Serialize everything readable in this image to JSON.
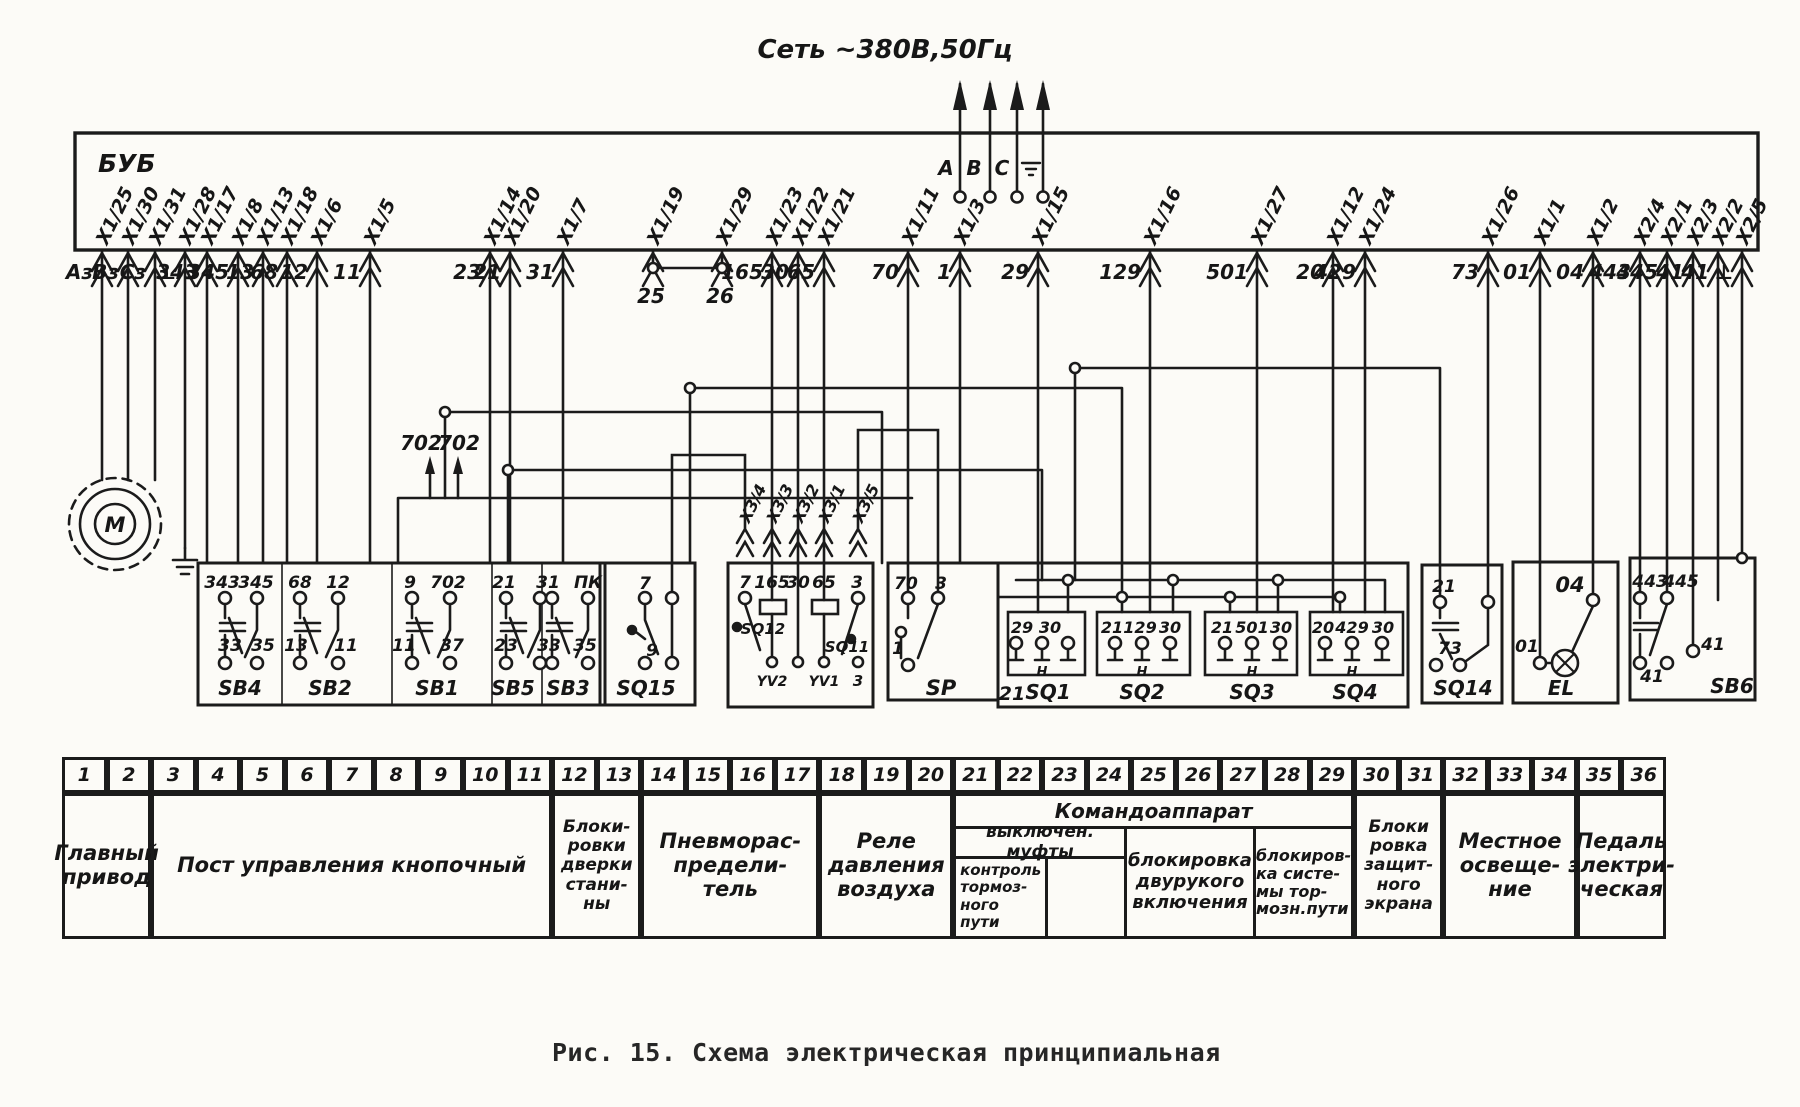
{
  "network": {
    "title": "Сеть ~380В,50Гц",
    "phase_a": "A",
    "phase_b": "B",
    "phase_c": "C"
  },
  "bub": {
    "name": "БУБ",
    "terminals": [
      {
        "t": "X1/25",
        "n": "Аз"
      },
      {
        "t": "X1/30",
        "n": "Вз"
      },
      {
        "t": "X1/31",
        "n": "Сз"
      },
      {
        "t": "X1/28",
        "n": "⊥"
      },
      {
        "t": "X1/17",
        "n": "343"
      },
      {
        "t": "X1/8",
        "n": "345"
      },
      {
        "t": "X1/13",
        "n": "13"
      },
      {
        "t": "X1/18",
        "n": "68"
      },
      {
        "t": "X1/6",
        "n": "12"
      },
      {
        "t": "X1/5",
        "n": "11"
      },
      {
        "t": "X1/14",
        "n": "23"
      },
      {
        "t": "X1/20",
        "n": "21"
      },
      {
        "t": "X1/7",
        "n": "31"
      },
      {
        "t": "X1/19",
        "n": "25"
      },
      {
        "t": "X1/29",
        "n": "26"
      },
      {
        "t": "X1/23",
        "n": "165"
      },
      {
        "t": "X1/22",
        "n": "30"
      },
      {
        "t": "X1/21",
        "n": "65"
      },
      {
        "t": "X1/11",
        "n": "70"
      },
      {
        "t": "X1/3",
        "n": "1"
      },
      {
        "t": "X1/15",
        "n": "29"
      },
      {
        "t": "X1/16",
        "n": "129"
      },
      {
        "t": "X1/27",
        "n": "501"
      },
      {
        "t": "X1/12",
        "n": "20"
      },
      {
        "t": "X1/24",
        "n": "429"
      },
      {
        "t": "X1/26",
        "n": "73"
      },
      {
        "t": "X1/1",
        "n": "01"
      },
      {
        "t": "X1/2",
        "n": "04"
      },
      {
        "t": "X2/4",
        "n": "443"
      },
      {
        "t": "X2/1",
        "n": "445"
      },
      {
        "t": "X2/3",
        "n": "41"
      },
      {
        "t": "X2/2",
        "n": "41"
      },
      {
        "t": "X2/5",
        "n": "⊥"
      }
    ]
  },
  "goto_702": {
    "a": "702",
    "b": "702"
  },
  "x3_labels": [
    "X3/4",
    "X3/3",
    "X3/2",
    "X3/1",
    "X3/5"
  ],
  "components": {
    "motor": {
      "label": "М"
    },
    "sb_station": {
      "top_labels": [
        "343",
        "345",
        "68",
        "12",
        "9",
        "702",
        "21",
        "31",
        "ПК"
      ],
      "bottom_labels": [
        "33",
        "35",
        "13",
        "11",
        "11",
        "37",
        "23",
        "33",
        "35"
      ],
      "names": [
        "SB4",
        "SB2",
        "SB1",
        "SB5",
        "SB3"
      ]
    },
    "sq15": {
      "top": "7",
      "bottom": "9",
      "name": "SQ15"
    },
    "pneumo": {
      "top_labels": [
        "7",
        "165",
        "30",
        "65",
        "3"
      ],
      "sw1": "SQ12",
      "sw2": "SQ11",
      "coil1": "YV2",
      "coil2": "YV1",
      "bottom_right": "3"
    },
    "sp": {
      "top_labels": [
        "70",
        "3"
      ],
      "mid": "1",
      "name": "SP"
    },
    "commander": {
      "corner": "21",
      "units": [
        {
          "labels": [
            "29",
            "30"
          ],
          "h": "Н",
          "name": "SQ1"
        },
        {
          "labels": [
            "21",
            "129",
            "30"
          ],
          "h": "Н",
          "name": "SQ2"
        },
        {
          "labels": [
            "21",
            "501",
            "30"
          ],
          "h": "Н",
          "name": "SQ3"
        },
        {
          "labels": [
            "20",
            "429",
            "30"
          ],
          "h": "Н",
          "name": "SQ4"
        }
      ]
    },
    "sq14": {
      "top": "21",
      "bottom": "73",
      "name": "SQ14"
    },
    "el": {
      "top": "04",
      "left": "01",
      "name": "EL"
    },
    "sb6": {
      "labels": [
        "443",
        "445",
        "41",
        "41"
      ],
      "name": "SB6"
    }
  },
  "table": {
    "columns": [
      "1",
      "2",
      "3",
      "4",
      "5",
      "6",
      "7",
      "8",
      "9",
      "10",
      "11",
      "12",
      "13",
      "14",
      "15",
      "16",
      "17",
      "18",
      "19",
      "20",
      "21",
      "22",
      "23",
      "24",
      "25",
      "26",
      "27",
      "28",
      "29",
      "30",
      "31",
      "32",
      "33",
      "34",
      "35",
      "36"
    ],
    "groups": [
      {
        "span": 2,
        "label": "Главный\nпривод"
      },
      {
        "span": 9,
        "label": "Пост управления кнопочный"
      },
      {
        "span": 2,
        "label": "Блоки-\nровки\nдверки\nстани-\nны"
      },
      {
        "span": 4,
        "label": "Пневморас-\nпредели-\nтель"
      },
      {
        "span": 3,
        "label": "Реле\nдавления\nвоздуха"
      },
      {
        "span": 9,
        "label": "Командоаппарат",
        "sub": {
          "clutch": "выключен. муфты",
          "brake_check": "контроль\nтормоз-\nного пути",
          "two_hand": "блокировка\nдвурукого\nвключения",
          "brake_sys": "блокиров-\nка систе-\nмы тор-\nмозн.пути"
        }
      },
      {
        "span": 2,
        "label": "Блоки\nровка\nзащит-\nного\nэкрана"
      },
      {
        "span": 3,
        "label": "Местное\nосвеще-\nние"
      },
      {
        "span": 2,
        "label": "Педаль\nэлектри-\nческая"
      }
    ]
  },
  "caption": "Рис. 15. Схема электрическая принципиальная"
}
